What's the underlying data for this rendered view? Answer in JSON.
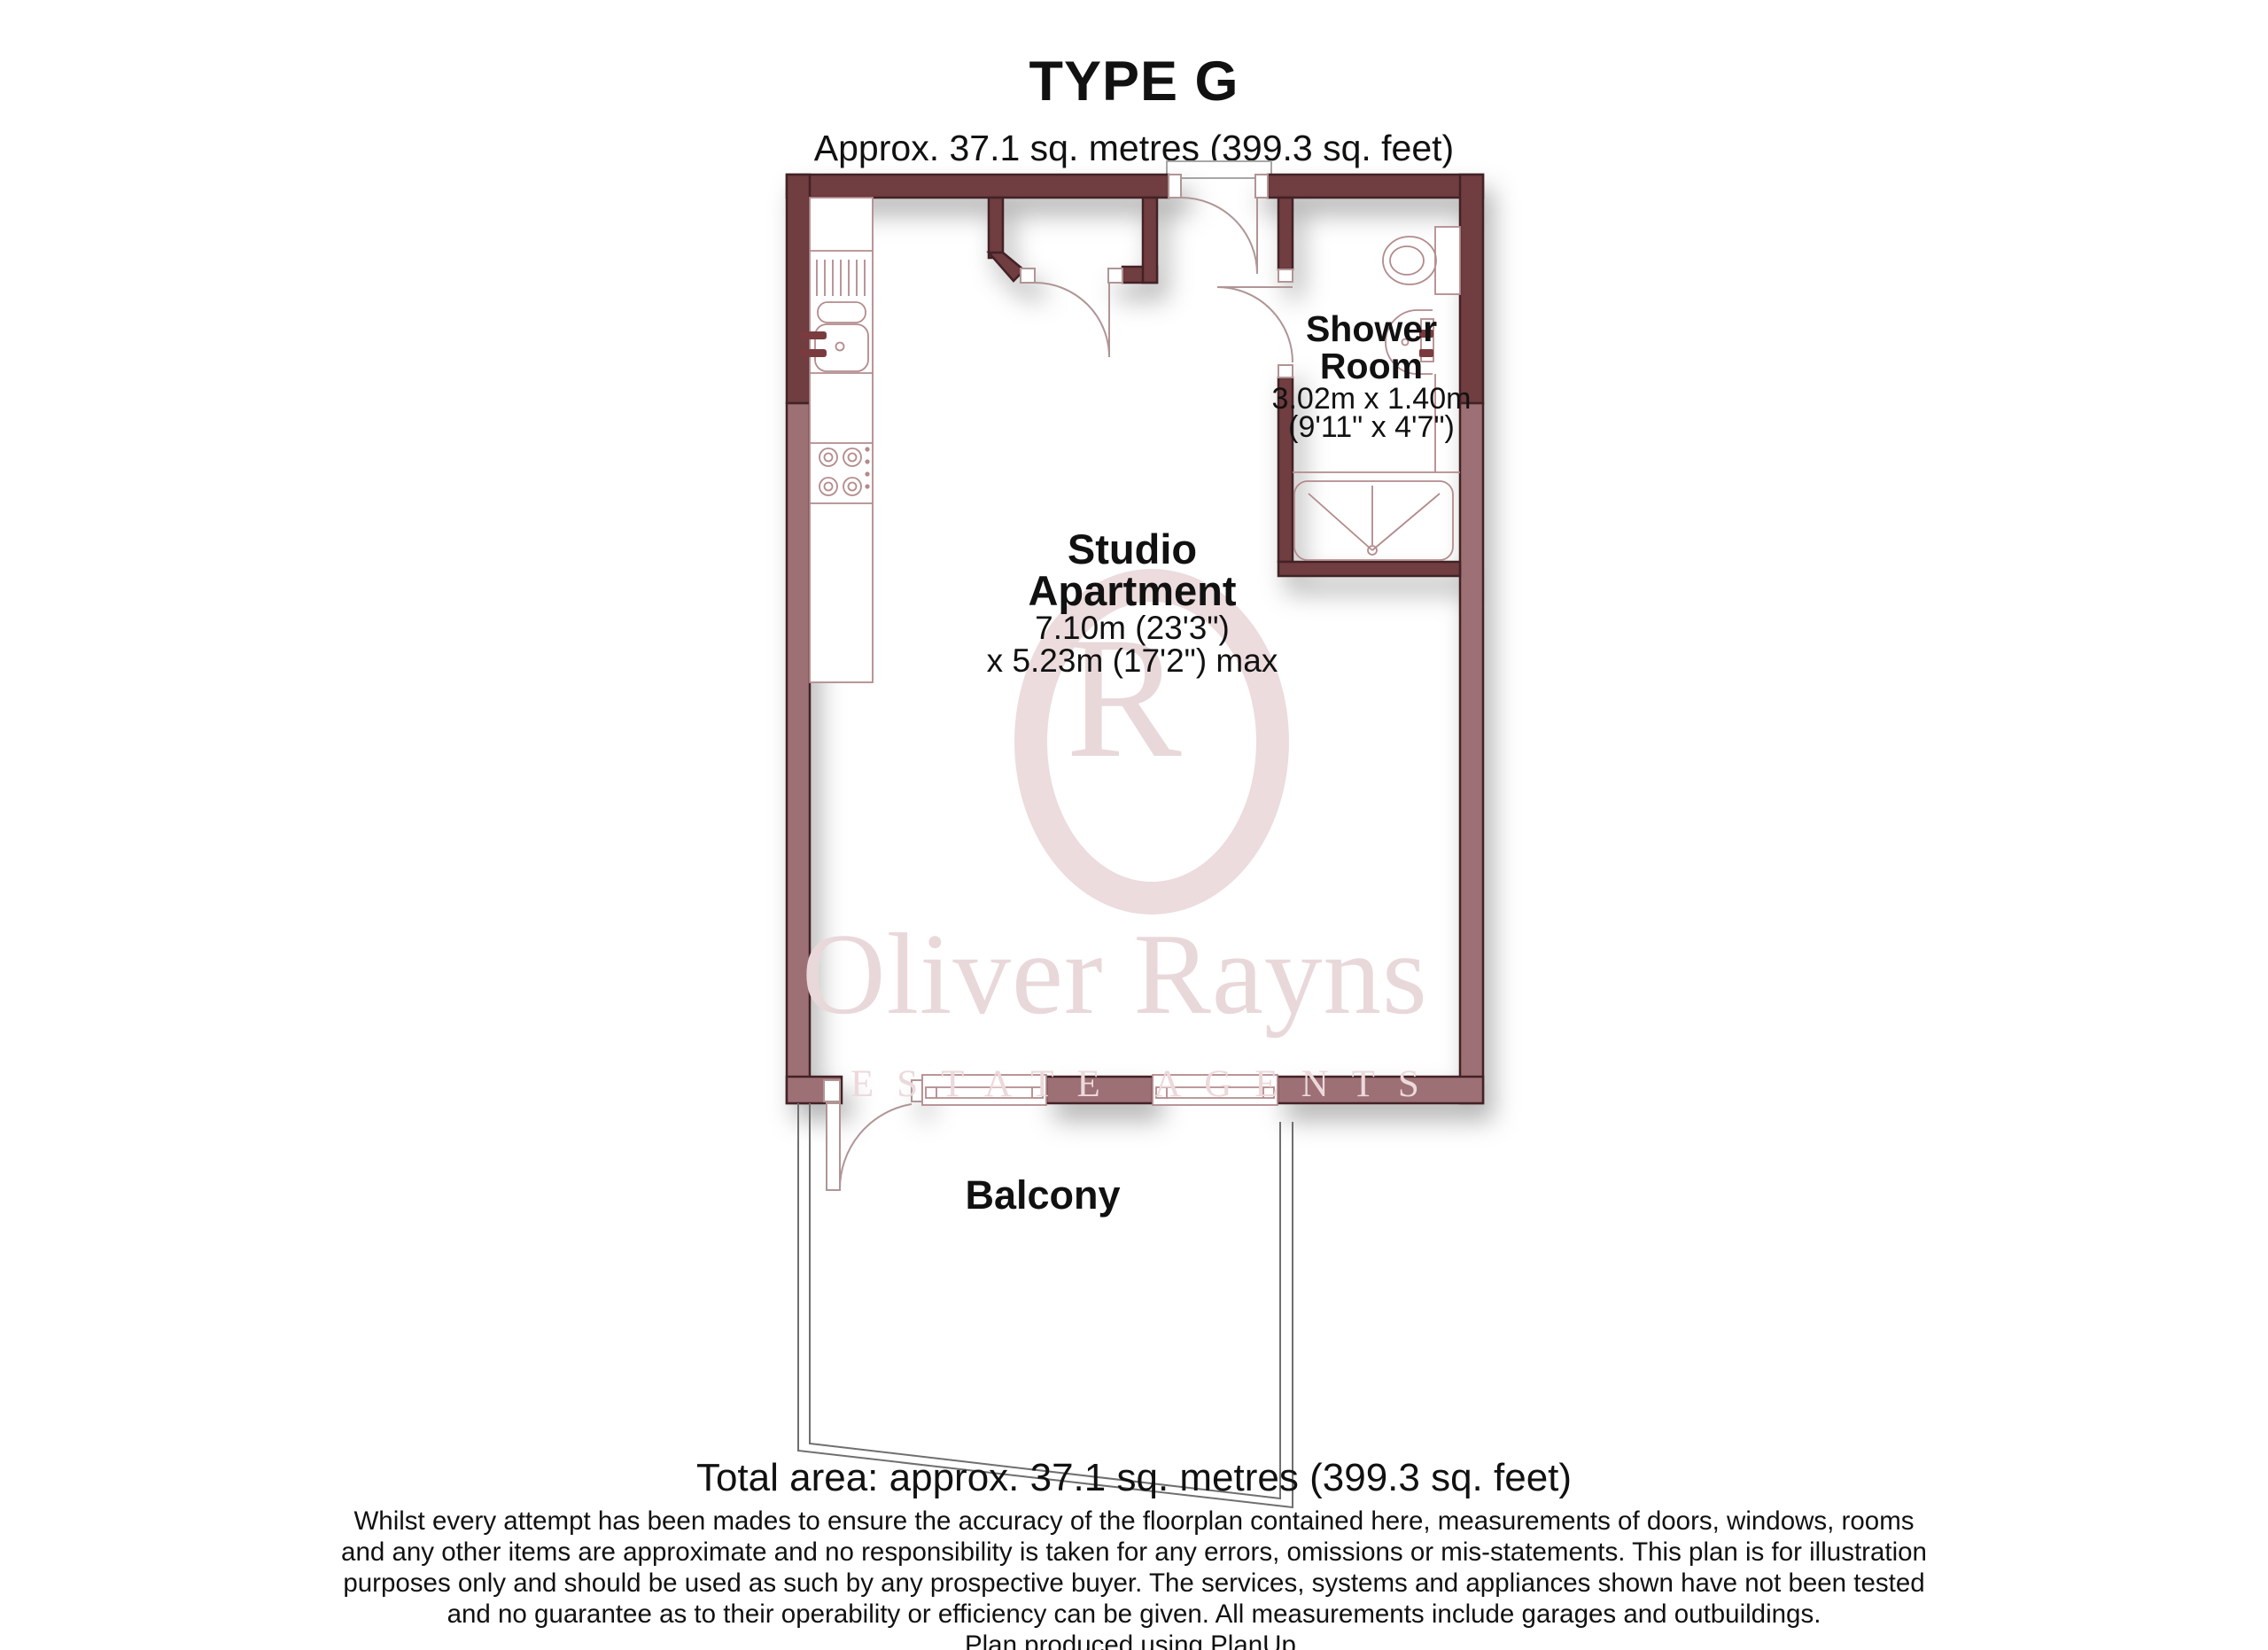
{
  "header": {
    "title": "TYPE G",
    "subtitle": "Approx. 37.1 sq. metres (399.3 sq. feet)"
  },
  "rooms": {
    "shower_room": {
      "name_line1": "Shower",
      "name_line2": "Room",
      "dimensions_metric": "3.02m x 1.40m",
      "dimensions_imperial": "(9'11\" x 4'7\")"
    },
    "studio": {
      "name_line1": "Studio",
      "name_line2": "Apartment",
      "dimensions_metric": "7.10m (23'3\")",
      "dimensions_imperial": "x 5.23m (17'2\") max"
    },
    "balcony": {
      "name": "Balcony"
    }
  },
  "watermark": {
    "monogram_o": "O",
    "monogram_r": "R",
    "brand_name": "Oliver Rayns",
    "brand_tagline": "ESTATE AGENTS"
  },
  "footer": {
    "total_area": "Total area: approx. 37.1 sq. metres (399.3 sq. feet)",
    "disclaimer_lines": [
      "Whilst every attempt has been mades to ensure the accuracy of the floorplan contained here, measurements of doors, windows, rooms",
      "and any other items are approximate and no responsibility is taken for any errors, omissions or mis-statements.  This plan is for illustration",
      "purposes only and should be used as such by any prospective buyer. The services, systems and appliances shown have not been tested",
      "and no guarantee as to their operability or efficiency can be given. All measurements include garages and outbuildings."
    ],
    "credit": "Plan produced using PlanUp."
  },
  "colors": {
    "wall_dark": "#6f3d41",
    "wall_light": "#9d7075",
    "wall_outline": "#432225",
    "fixture_line": "#b38b8d",
    "door_line": "#b09595",
    "tap_red": "#7a3b3f",
    "watermark_pink": "#e9d8da",
    "balcony_line": "#6f6f6f"
  }
}
